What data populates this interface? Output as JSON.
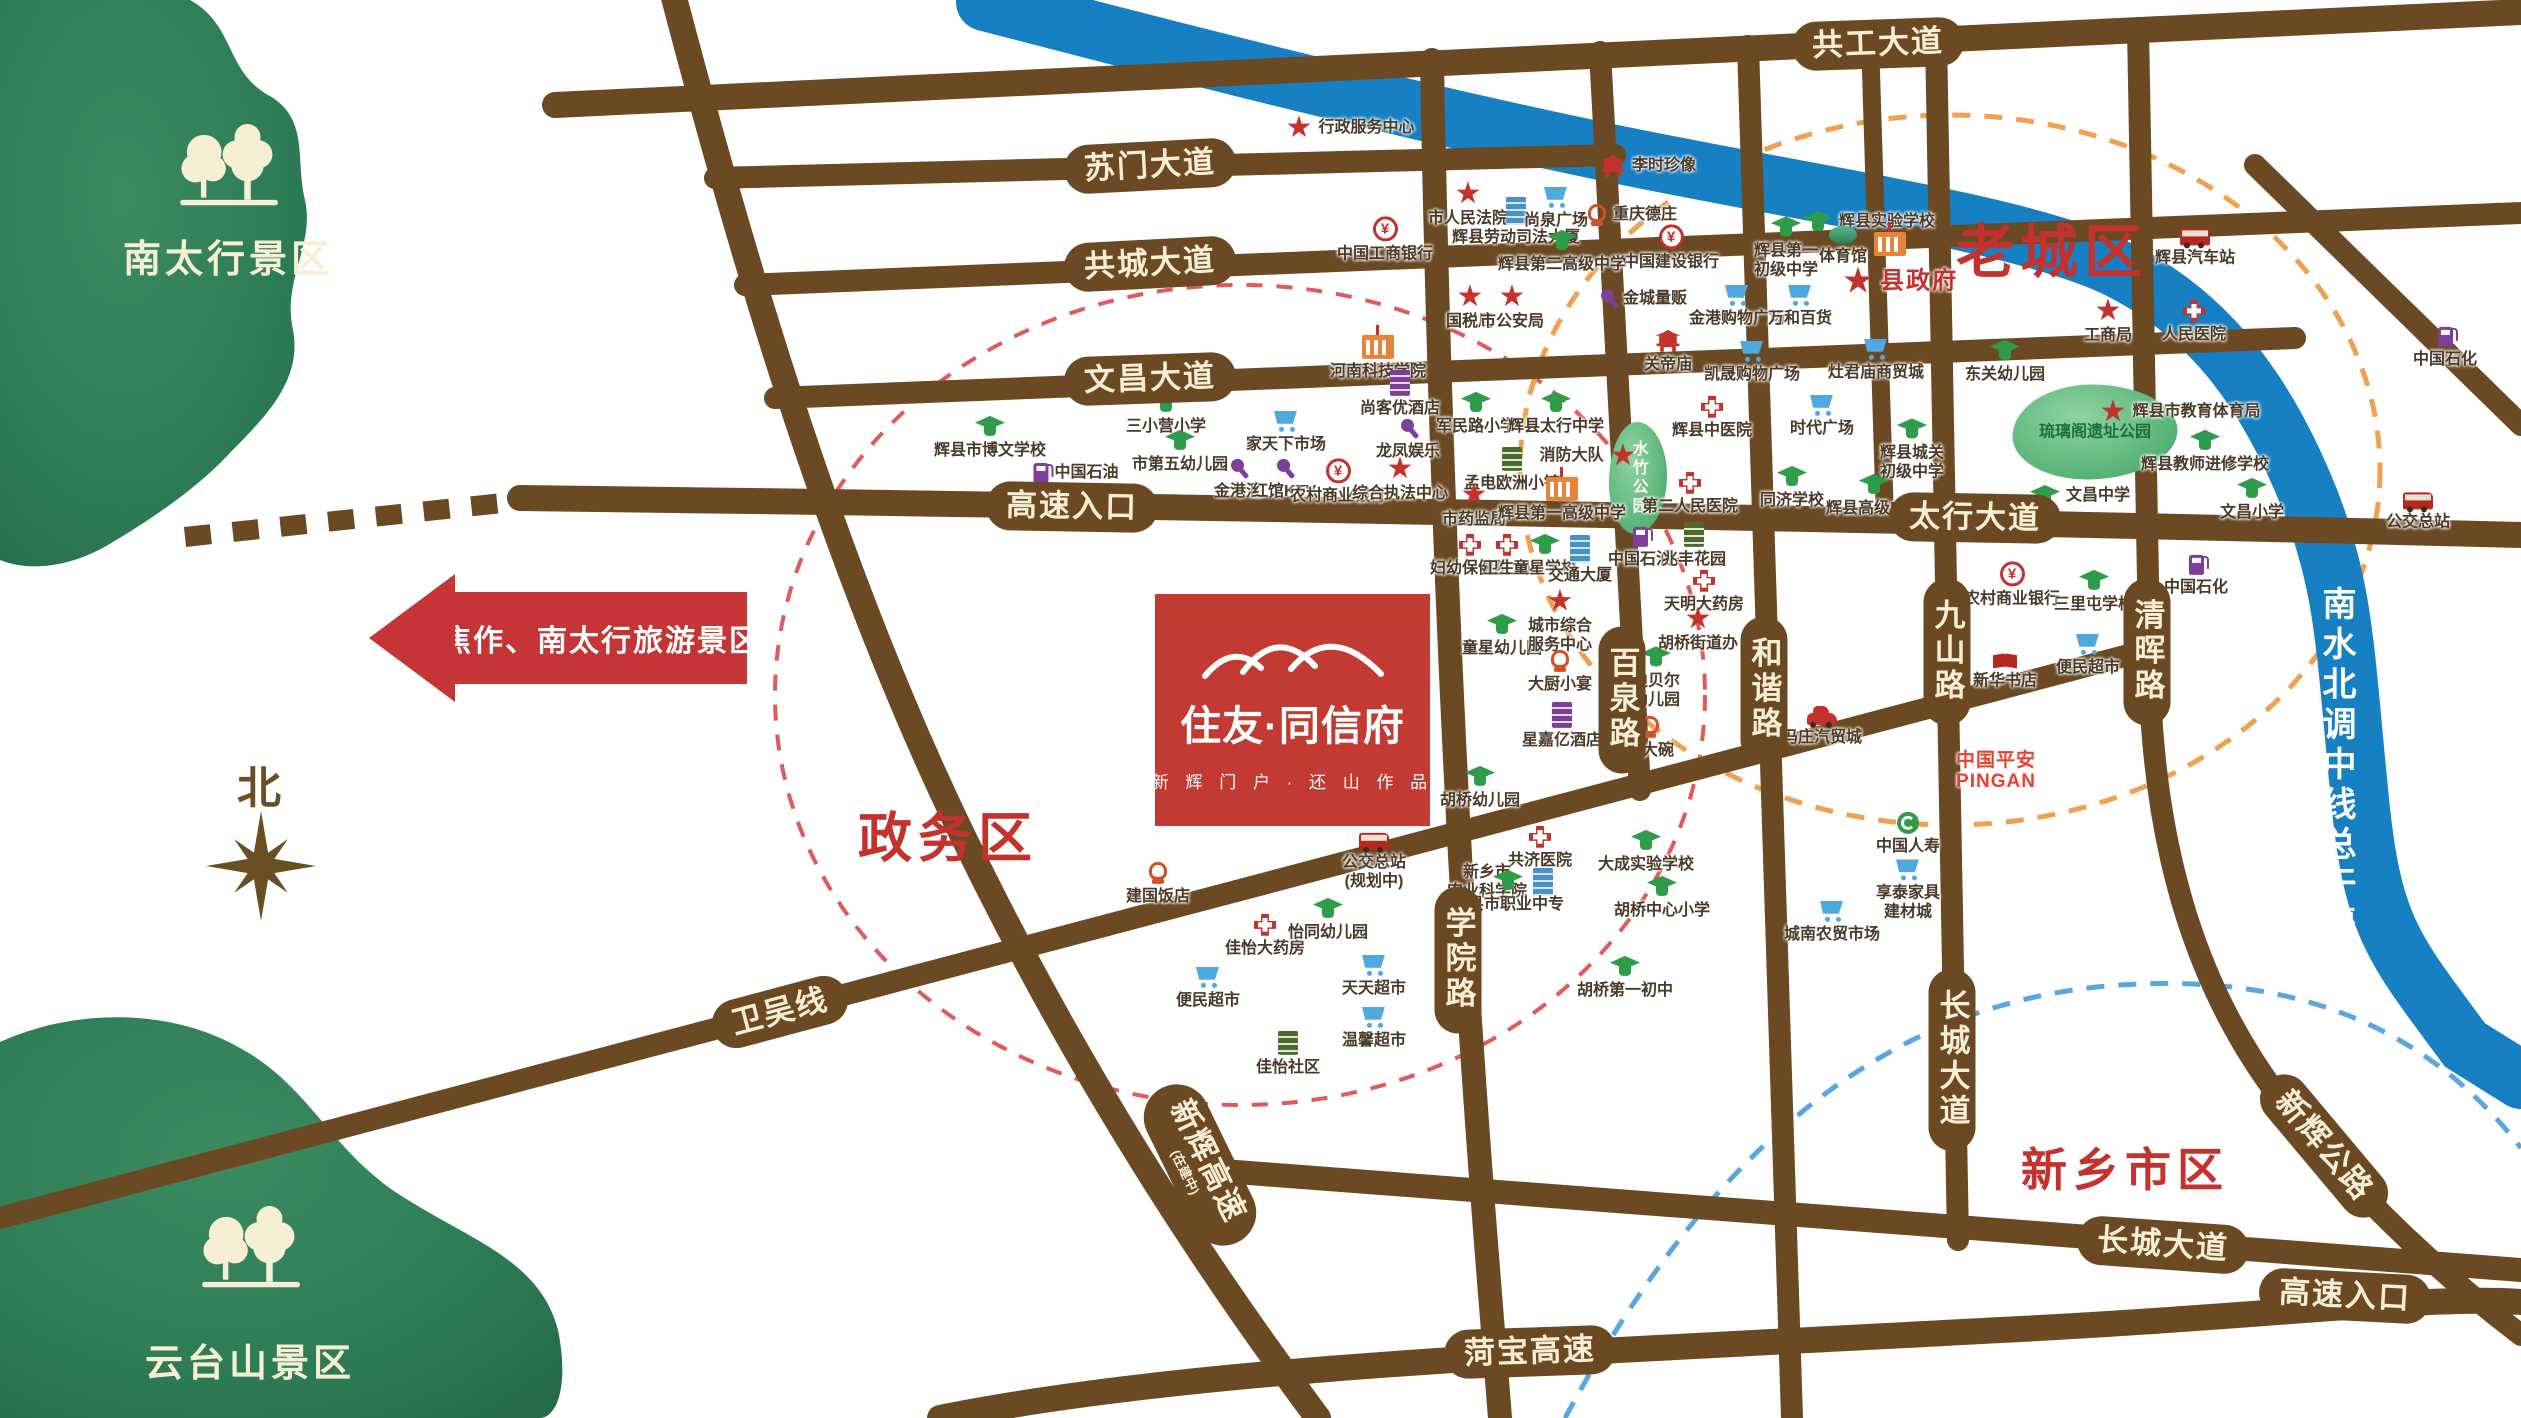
{
  "logo": {
    "title": "住友·同信府",
    "subtitle": "新 辉 门 户 · 还 山 作 品"
  },
  "arrow": {
    "label": "焦作、南太行旅游景区"
  },
  "compass": {
    "label": "北"
  },
  "river": {
    "label": "南水北调中线总干渠"
  },
  "scenic": {
    "taihang": {
      "label": "南太行景区"
    },
    "yuntai": {
      "label": "云台山景区"
    }
  },
  "areas": [
    {
      "label": "老城区",
      "x": 2052,
      "y": 247,
      "size": 58
    },
    {
      "label": "政务区",
      "x": 948,
      "y": 833,
      "size": 54
    },
    {
      "label": "新乡市区",
      "x": 2125,
      "y": 1167,
      "size": 46
    }
  ],
  "road_labels": [
    {
      "label": "共工大道",
      "x": 1878,
      "y": 44,
      "rot": -2
    },
    {
      "label": "苏门大道",
      "x": 1150,
      "y": 166,
      "rot": -3
    },
    {
      "label": "共城大道",
      "x": 1150,
      "y": 264,
      "rot": -3
    },
    {
      "label": "文昌大道",
      "x": 1150,
      "y": 379,
      "rot": -2
    },
    {
      "label": "高速入口",
      "x": 1072,
      "y": 507,
      "rot": 1
    },
    {
      "label": "太行大道",
      "x": 1975,
      "y": 518,
      "rot": 1
    },
    {
      "label": "卫吴线",
      "x": 780,
      "y": 1012,
      "rot": -15
    },
    {
      "label": "学院路",
      "x": 1458,
      "y": 960,
      "vertical": true
    },
    {
      "label": "百泉路",
      "x": 1622,
      "y": 700,
      "vertical": true
    },
    {
      "label": "和谐路",
      "x": 1764,
      "y": 690,
      "vertical": true
    },
    {
      "label": "九山路",
      "x": 1947,
      "y": 652,
      "vertical": true
    },
    {
      "label": "清晖路",
      "x": 2147,
      "y": 652,
      "vertical": true
    },
    {
      "label": "长城大道",
      "x": 1952,
      "y": 1060,
      "vertical": true
    },
    {
      "label": "长城大道",
      "x": 2163,
      "y": 1245,
      "rot": 4
    },
    {
      "label": "新辉高速",
      "sub": "(在建中)",
      "x": 1200,
      "y": 1165,
      "rot": 64,
      "diag": true
    },
    {
      "label": "新辉公路",
      "x": 2324,
      "y": 1146,
      "rot": 50
    },
    {
      "label": "菏宝高速",
      "x": 1530,
      "y": 1352,
      "rot": -2
    },
    {
      "label": "高速入口",
      "x": 2345,
      "y": 1296,
      "rot": 3
    }
  ],
  "parks": [
    {
      "label": "琉璃阁遗址公园",
      "x": 2095,
      "y": 432,
      "w": 165,
      "h": 95
    },
    {
      "label": "水竹公园",
      "x": 1638,
      "y": 478,
      "w": 58,
      "h": 112,
      "v": true
    }
  ],
  "pois": [
    {
      "x": 1350,
      "y": 128,
      "i": "star",
      "l": "行政服务中心",
      "lp": "r"
    },
    {
      "x": 1648,
      "y": 166,
      "i": "temple",
      "l": "李时珍像",
      "lp": "r"
    },
    {
      "x": 1468,
      "y": 205,
      "i": "star",
      "l": "市人民法院"
    },
    {
      "x": 1516,
      "y": 222,
      "i": "tower",
      "l": "辉县劳动司法大厦"
    },
    {
      "x": 1556,
      "y": 208,
      "i": "cart",
      "l": "尚泉广场"
    },
    {
      "x": 1632,
      "y": 215,
      "i": "food",
      "l": "重庆德庄",
      "lp": "r"
    },
    {
      "x": 1385,
      "y": 240,
      "i": "bank",
      "l": "中国工商银行"
    },
    {
      "x": 1671,
      "y": 248,
      "i": "bank",
      "l": "中国建设银行"
    },
    {
      "x": 1562,
      "y": 252,
      "i": "school",
      "l": "辉县第二高级中学"
    },
    {
      "x": 1869,
      "y": 222,
      "i": "school",
      "l": "辉县实验学校",
      "lp": "r"
    },
    {
      "x": 1786,
      "y": 248,
      "i": "school",
      "l": "辉县第一\n初级中学"
    },
    {
      "x": 1843,
      "y": 246,
      "i": "stadium",
      "l": "体育馆"
    },
    {
      "x": 1890,
      "y": 244,
      "i": "campus",
      "l": ""
    },
    {
      "x": 1900,
      "y": 282,
      "i": "star",
      "l": "县政府",
      "lp": "r",
      "cls": "red-big",
      "big": true
    },
    {
      "x": 1470,
      "y": 308,
      "i": "star",
      "l": "国税局"
    },
    {
      "x": 1512,
      "y": 308,
      "i": "star",
      "l": "市公安局"
    },
    {
      "x": 1643,
      "y": 299,
      "i": "mic",
      "l": "金城量贩",
      "lp": "r"
    },
    {
      "x": 1668,
      "y": 352,
      "i": "temple",
      "l": "关帝庙"
    },
    {
      "x": 1737,
      "y": 306,
      "i": "cart",
      "l": "金港购物广场"
    },
    {
      "x": 1800,
      "y": 306,
      "i": "cart",
      "l": "万和百货"
    },
    {
      "x": 1752,
      "y": 362,
      "i": "cart",
      "l": "凯晟购物广场"
    },
    {
      "x": 1876,
      "y": 360,
      "i": "cart",
      "l": "灶君庙商贸城"
    },
    {
      "x": 1378,
      "y": 358,
      "i": "campus",
      "l": "河南科技学院"
    },
    {
      "x": 2005,
      "y": 362,
      "i": "school",
      "l": "东关幼儿园"
    },
    {
      "x": 2108,
      "y": 322,
      "i": "star",
      "l": "工商局"
    },
    {
      "x": 2194,
      "y": 322,
      "i": "hosp",
      "l": "人民医院"
    },
    {
      "x": 2195,
      "y": 248,
      "i": "bus",
      "l": "辉县汽车站"
    },
    {
      "x": 990,
      "y": 438,
      "i": "school",
      "l": "辉县市博文学校"
    },
    {
      "x": 1076,
      "y": 473,
      "i": "gas",
      "l": "中国石油",
      "lp": "r"
    },
    {
      "x": 1166,
      "y": 414,
      "i": "school",
      "l": "三小营小学"
    },
    {
      "x": 1180,
      "y": 452,
      "i": "school",
      "l": "市第五幼儿园"
    },
    {
      "x": 1286,
      "y": 432,
      "i": "cart",
      "l": "家天下市场"
    },
    {
      "x": 1400,
      "y": 394,
      "i": "hotel",
      "l": "尚客优酒店"
    },
    {
      "x": 1408,
      "y": 440,
      "i": "mic",
      "l": "龙凤娱乐"
    },
    {
      "x": 1238,
      "y": 480,
      "i": "mic",
      "l": "金港汇"
    },
    {
      "x": 1284,
      "y": 480,
      "i": "mic",
      "l": "红馆KTV"
    },
    {
      "x": 1338,
      "y": 482,
      "i": "bank",
      "l": "农村商业银行"
    },
    {
      "x": 1400,
      "y": 480,
      "i": "star",
      "l": "综合执法中心"
    },
    {
      "x": 1476,
      "y": 414,
      "i": "school",
      "l": "军民路小学"
    },
    {
      "x": 1556,
      "y": 414,
      "i": "school",
      "l": "辉县太行中学"
    },
    {
      "x": 1588,
      "y": 456,
      "i": "star",
      "l": "消防大队",
      "lp": "l"
    },
    {
      "x": 1512,
      "y": 470,
      "i": "bgreen",
      "l": "孟电欧洲小镇"
    },
    {
      "x": 1474,
      "y": 506,
      "i": "star",
      "l": "市药监局"
    },
    {
      "x": 1562,
      "y": 500,
      "i": "campus",
      "l": "辉县第一高级中学"
    },
    {
      "x": 1712,
      "y": 418,
      "i": "hosp",
      "l": "辉县中医院"
    },
    {
      "x": 1690,
      "y": 494,
      "i": "hosp",
      "l": "第二人民医院"
    },
    {
      "x": 1822,
      "y": 416,
      "i": "cart",
      "l": "时代广场"
    },
    {
      "x": 1912,
      "y": 450,
      "i": "school",
      "l": "辉县城关\n初级中学"
    },
    {
      "x": 1792,
      "y": 488,
      "i": "school",
      "l": "同济学校"
    },
    {
      "x": 1874,
      "y": 496,
      "i": "school",
      "l": "辉县高级中学"
    },
    {
      "x": 2180,
      "y": 412,
      "i": "star",
      "l": "辉县市教育体育局",
      "lp": "r"
    },
    {
      "x": 2205,
      "y": 452,
      "i": "school",
      "l": "辉县教师进修学校"
    },
    {
      "x": 2080,
      "y": 496,
      "i": "school",
      "l": "文昌中学",
      "lp": "r"
    },
    {
      "x": 2252,
      "y": 500,
      "i": "school",
      "l": "文昌小学"
    },
    {
      "x": 2418,
      "y": 512,
      "i": "bus",
      "l": "公交总站"
    },
    {
      "x": 1470,
      "y": 556,
      "i": "hosp",
      "l": "妇幼保健院"
    },
    {
      "x": 1507,
      "y": 556,
      "i": "hosp",
      "l": "卫生局"
    },
    {
      "x": 1545,
      "y": 556,
      "i": "school",
      "l": "童星学校"
    },
    {
      "x": 1580,
      "y": 560,
      "i": "tower",
      "l": "交通大厦"
    },
    {
      "x": 1640,
      "y": 548,
      "i": "gas",
      "l": "中国石油"
    },
    {
      "x": 1694,
      "y": 546,
      "i": "bgreen",
      "l": "兆丰花园"
    },
    {
      "x": 1704,
      "y": 592,
      "i": "hosp",
      "l": "天明大药房"
    },
    {
      "x": 1698,
      "y": 630,
      "i": "star",
      "l": "胡桥街道办"
    },
    {
      "x": 1502,
      "y": 636,
      "i": "school",
      "l": "童星幼儿园"
    },
    {
      "x": 1560,
      "y": 622,
      "i": "star",
      "l": "城市综合\n服务中心"
    },
    {
      "x": 1656,
      "y": 678,
      "i": "school",
      "l": "迪贝尔\n幼儿园"
    },
    {
      "x": 1560,
      "y": 672,
      "i": "food",
      "l": "大厨小宴"
    },
    {
      "x": 1562,
      "y": 726,
      "i": "hotel",
      "l": "星嘉亿酒店"
    },
    {
      "x": 1650,
      "y": 738,
      "i": "food",
      "l": "食大碗"
    },
    {
      "x": 1480,
      "y": 788,
      "i": "school",
      "l": "胡桥幼儿园"
    },
    {
      "x": 1540,
      "y": 848,
      "i": "hosp",
      "l": "共济医院"
    },
    {
      "x": 1374,
      "y": 862,
      "i": "bus",
      "l": "公交总站\n(规划中)"
    },
    {
      "x": 2012,
      "y": 585,
      "i": "bank",
      "l": "农村商业银行"
    },
    {
      "x": 2094,
      "y": 592,
      "i": "school",
      "l": "三里屯学校"
    },
    {
      "x": 2196,
      "y": 576,
      "i": "gas",
      "l": "中国石化"
    },
    {
      "x": 2445,
      "y": 348,
      "i": "gas",
      "l": "中国石化"
    },
    {
      "x": 2005,
      "y": 672,
      "i": "book",
      "l": "新华书店"
    },
    {
      "x": 2088,
      "y": 655,
      "i": "cart",
      "l": "便民超市"
    },
    {
      "x": 1822,
      "y": 726,
      "i": "car",
      "l": "冯庄汽贸城"
    },
    {
      "x": 1996,
      "y": 772,
      "i": "none",
      "l": "中国平安\nPINGAN",
      "cls": "pingan"
    },
    {
      "x": 1908,
      "y": 834,
      "i": "life",
      "l": "中国人寿"
    },
    {
      "x": 1500,
      "y": 882,
      "i": "tower",
      "l": "新乡市\n农业科学院",
      "lp": "l"
    },
    {
      "x": 1158,
      "y": 884,
      "i": "food",
      "l": "建国饭店"
    },
    {
      "x": 1265,
      "y": 936,
      "i": "hosp",
      "l": "佳怡大药房"
    },
    {
      "x": 1328,
      "y": 920,
      "i": "school",
      "l": "怡同幼儿园"
    },
    {
      "x": 1208,
      "y": 988,
      "i": "cart",
      "l": "便民超市"
    },
    {
      "x": 1374,
      "y": 976,
      "i": "cart",
      "l": "天天超市"
    },
    {
      "x": 1374,
      "y": 1028,
      "i": "cart",
      "l": "温馨超市"
    },
    {
      "x": 1288,
      "y": 1054,
      "i": "bgreen",
      "l": "佳怡社区"
    },
    {
      "x": 1508,
      "y": 892,
      "i": "school",
      "l": "辉县市职业中专"
    },
    {
      "x": 1646,
      "y": 852,
      "i": "school",
      "l": "大成实验学校"
    },
    {
      "x": 1662,
      "y": 898,
      "i": "school",
      "l": "胡桥中心小学"
    },
    {
      "x": 1625,
      "y": 978,
      "i": "school",
      "l": "胡桥第一初中"
    },
    {
      "x": 1832,
      "y": 922,
      "i": "cart",
      "l": "城南农贸市场"
    },
    {
      "x": 1908,
      "y": 890,
      "i": "cart",
      "l": "享泰家具\n建材城"
    }
  ]
}
